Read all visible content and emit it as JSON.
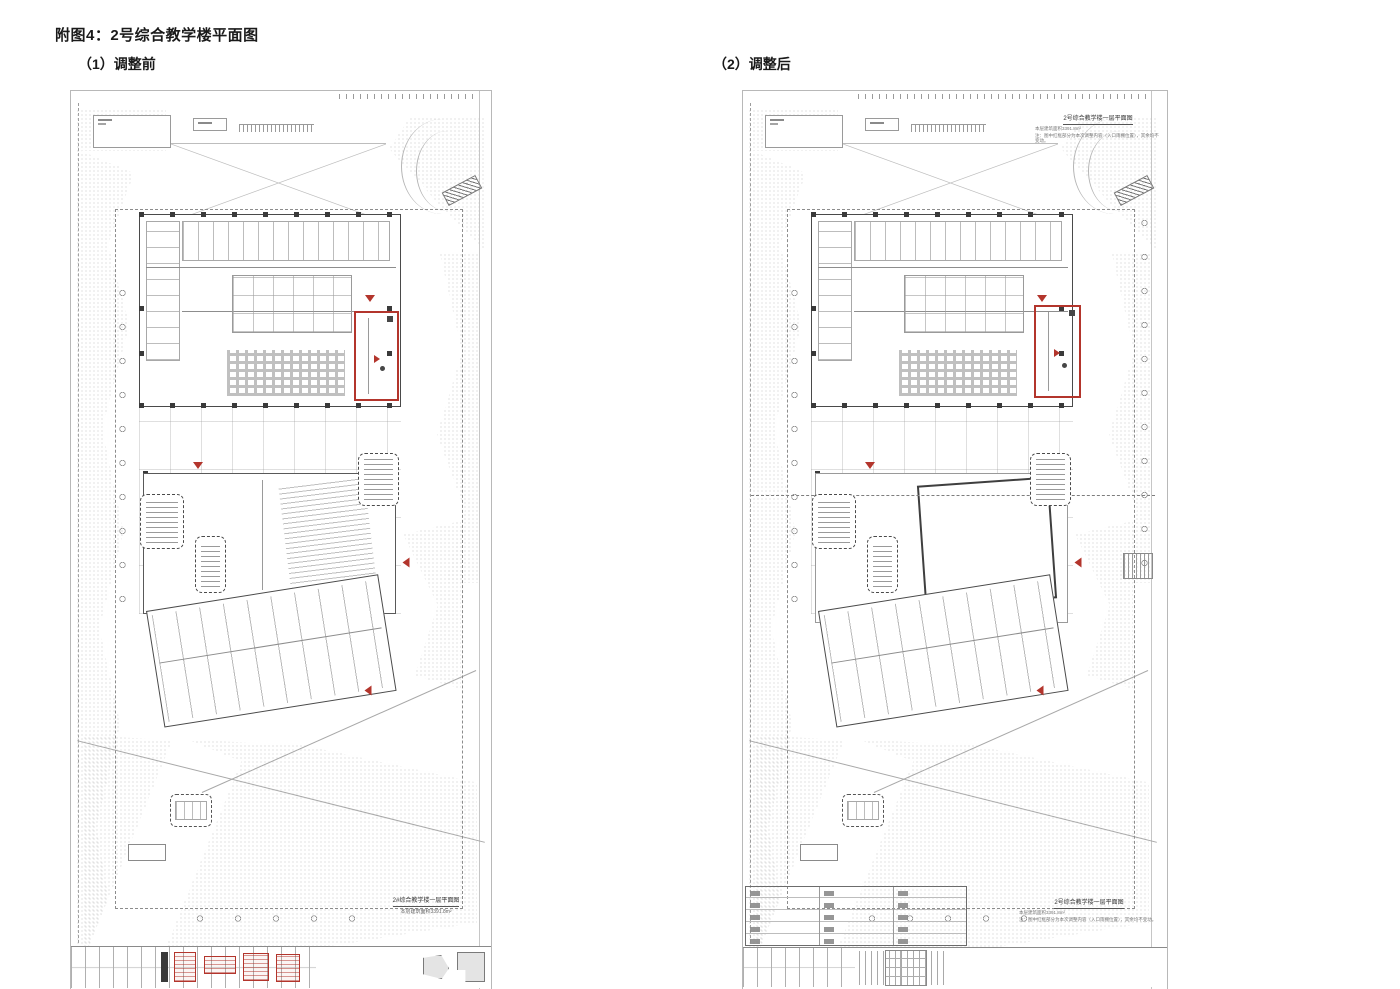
{
  "page": {
    "title": "附图4：2号综合教学楼平面图"
  },
  "panels": {
    "before_label": "（1）调整前",
    "after_label": "（2）调整后"
  },
  "sheet_before": {
    "caption": "2#综合教学楼一层平面图",
    "caption_sub": "本层建筑面积3391.8m²"
  },
  "sheet_after": {
    "top_title": "2号综合教学楼一层平面图",
    "top_note1": "本层建筑面积3391.8m²",
    "top_note2": "注：图中红框部分为本次调整内容（入口雨棚位置），其余均不变动。",
    "bottom_title": "2号综合教学楼一层平面图",
    "bottom_note1": "本层建筑面积3391.8m²",
    "bottom_note2": "注：图中红框部分为本次调整内容（入口雨棚位置），其余均不变动。"
  },
  "colors": {
    "highlight_red": "#b3352c",
    "line_gray": "#9a9a9a",
    "wall_dark": "#4a4a4a"
  },
  "icons": {
    "entrance_marker": "red-triangle",
    "change_highlight": "red-rectangle"
  }
}
